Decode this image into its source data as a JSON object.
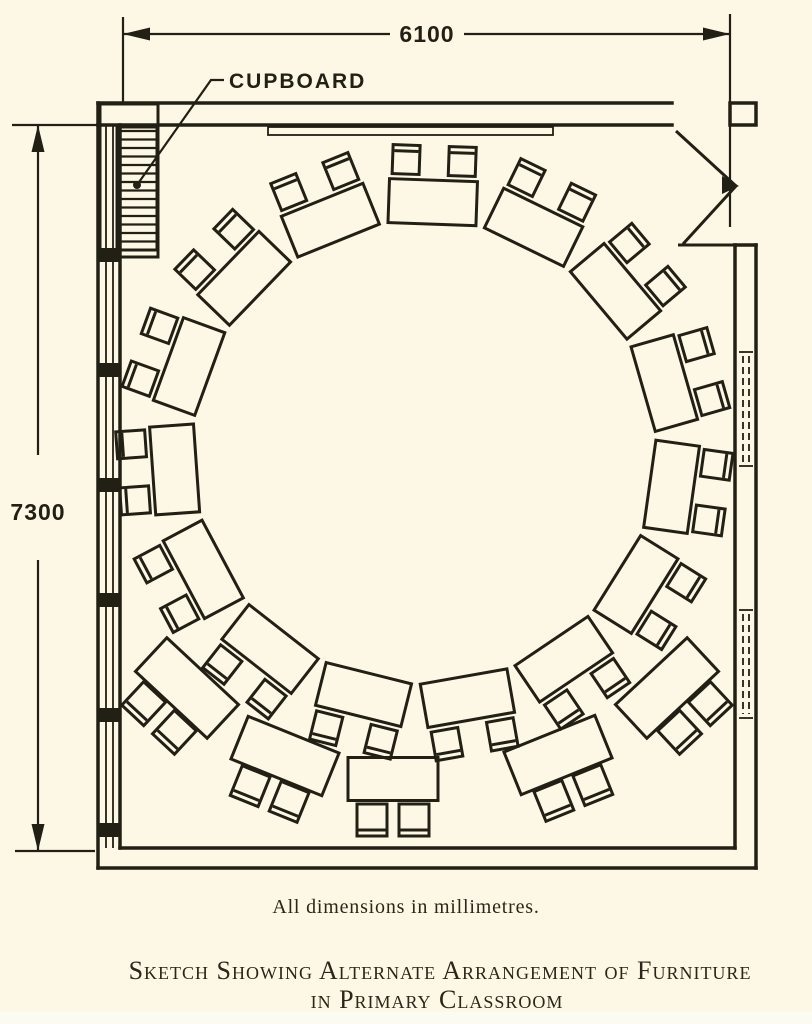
{
  "page": {
    "background": "#fdf8e6",
    "ink": "#221f15",
    "bottom_band": "#fcfbf2"
  },
  "annotations": {
    "width_dimension": "6100",
    "height_dimension": "7300",
    "cupboard_label": "CUPBOARD",
    "caption": "All dimensions in millimetres.",
    "title_line1": "Sketch Showing Alternate Arrangement of Furniture",
    "title_line2": "in Primary Classroom"
  },
  "plan": {
    "ring": {
      "cx": 424,
      "cy": 452,
      "desk_count": 15,
      "start_angle_deg": -88,
      "step_deg": 24,
      "desk_radius": 250,
      "desk_length": 88,
      "desk_depth": 44,
      "chair_radius": 293,
      "chair_pair_half_angle_deg": 5.5,
      "chair_w": 27,
      "chair_h": 29
    },
    "outer_tables": [
      {
        "cx": 187,
        "cy": 688,
        "rot": 43,
        "w": 98,
        "h": 46
      },
      {
        "cx": 285,
        "cy": 756,
        "rot": 22,
        "w": 98,
        "h": 46
      },
      {
        "cx": 393,
        "cy": 779,
        "rot": 0,
        "w": 90,
        "h": 43
      },
      {
        "cx": 558,
        "cy": 755,
        "rot": -22,
        "w": 98,
        "h": 46
      },
      {
        "cx": 667,
        "cy": 688,
        "rot": -43,
        "w": 98,
        "h": 46
      }
    ],
    "table_chair": {
      "dx": 21,
      "dy": 41,
      "w": 30,
      "h": 32
    },
    "cupboard_hatch": {
      "x1": 118.5,
      "x2": 155.5,
      "y1": 131,
      "y2": 248,
      "step": 8.5
    },
    "window_wall": {
      "x_outer": 98,
      "x_inner": 120,
      "glass_x": [
        106,
        113
      ],
      "top": 125,
      "bottom": 848
    },
    "window_piers_y": [
      248,
      363,
      478,
      593,
      708,
      823
    ],
    "pier_h": 14,
    "partition": {
      "x_dash": [
        743,
        749
      ],
      "tick_x1": 739,
      "tick_x2": 753,
      "segments": [
        [
          352,
          466
        ],
        [
          610,
          718
        ]
      ]
    }
  }
}
